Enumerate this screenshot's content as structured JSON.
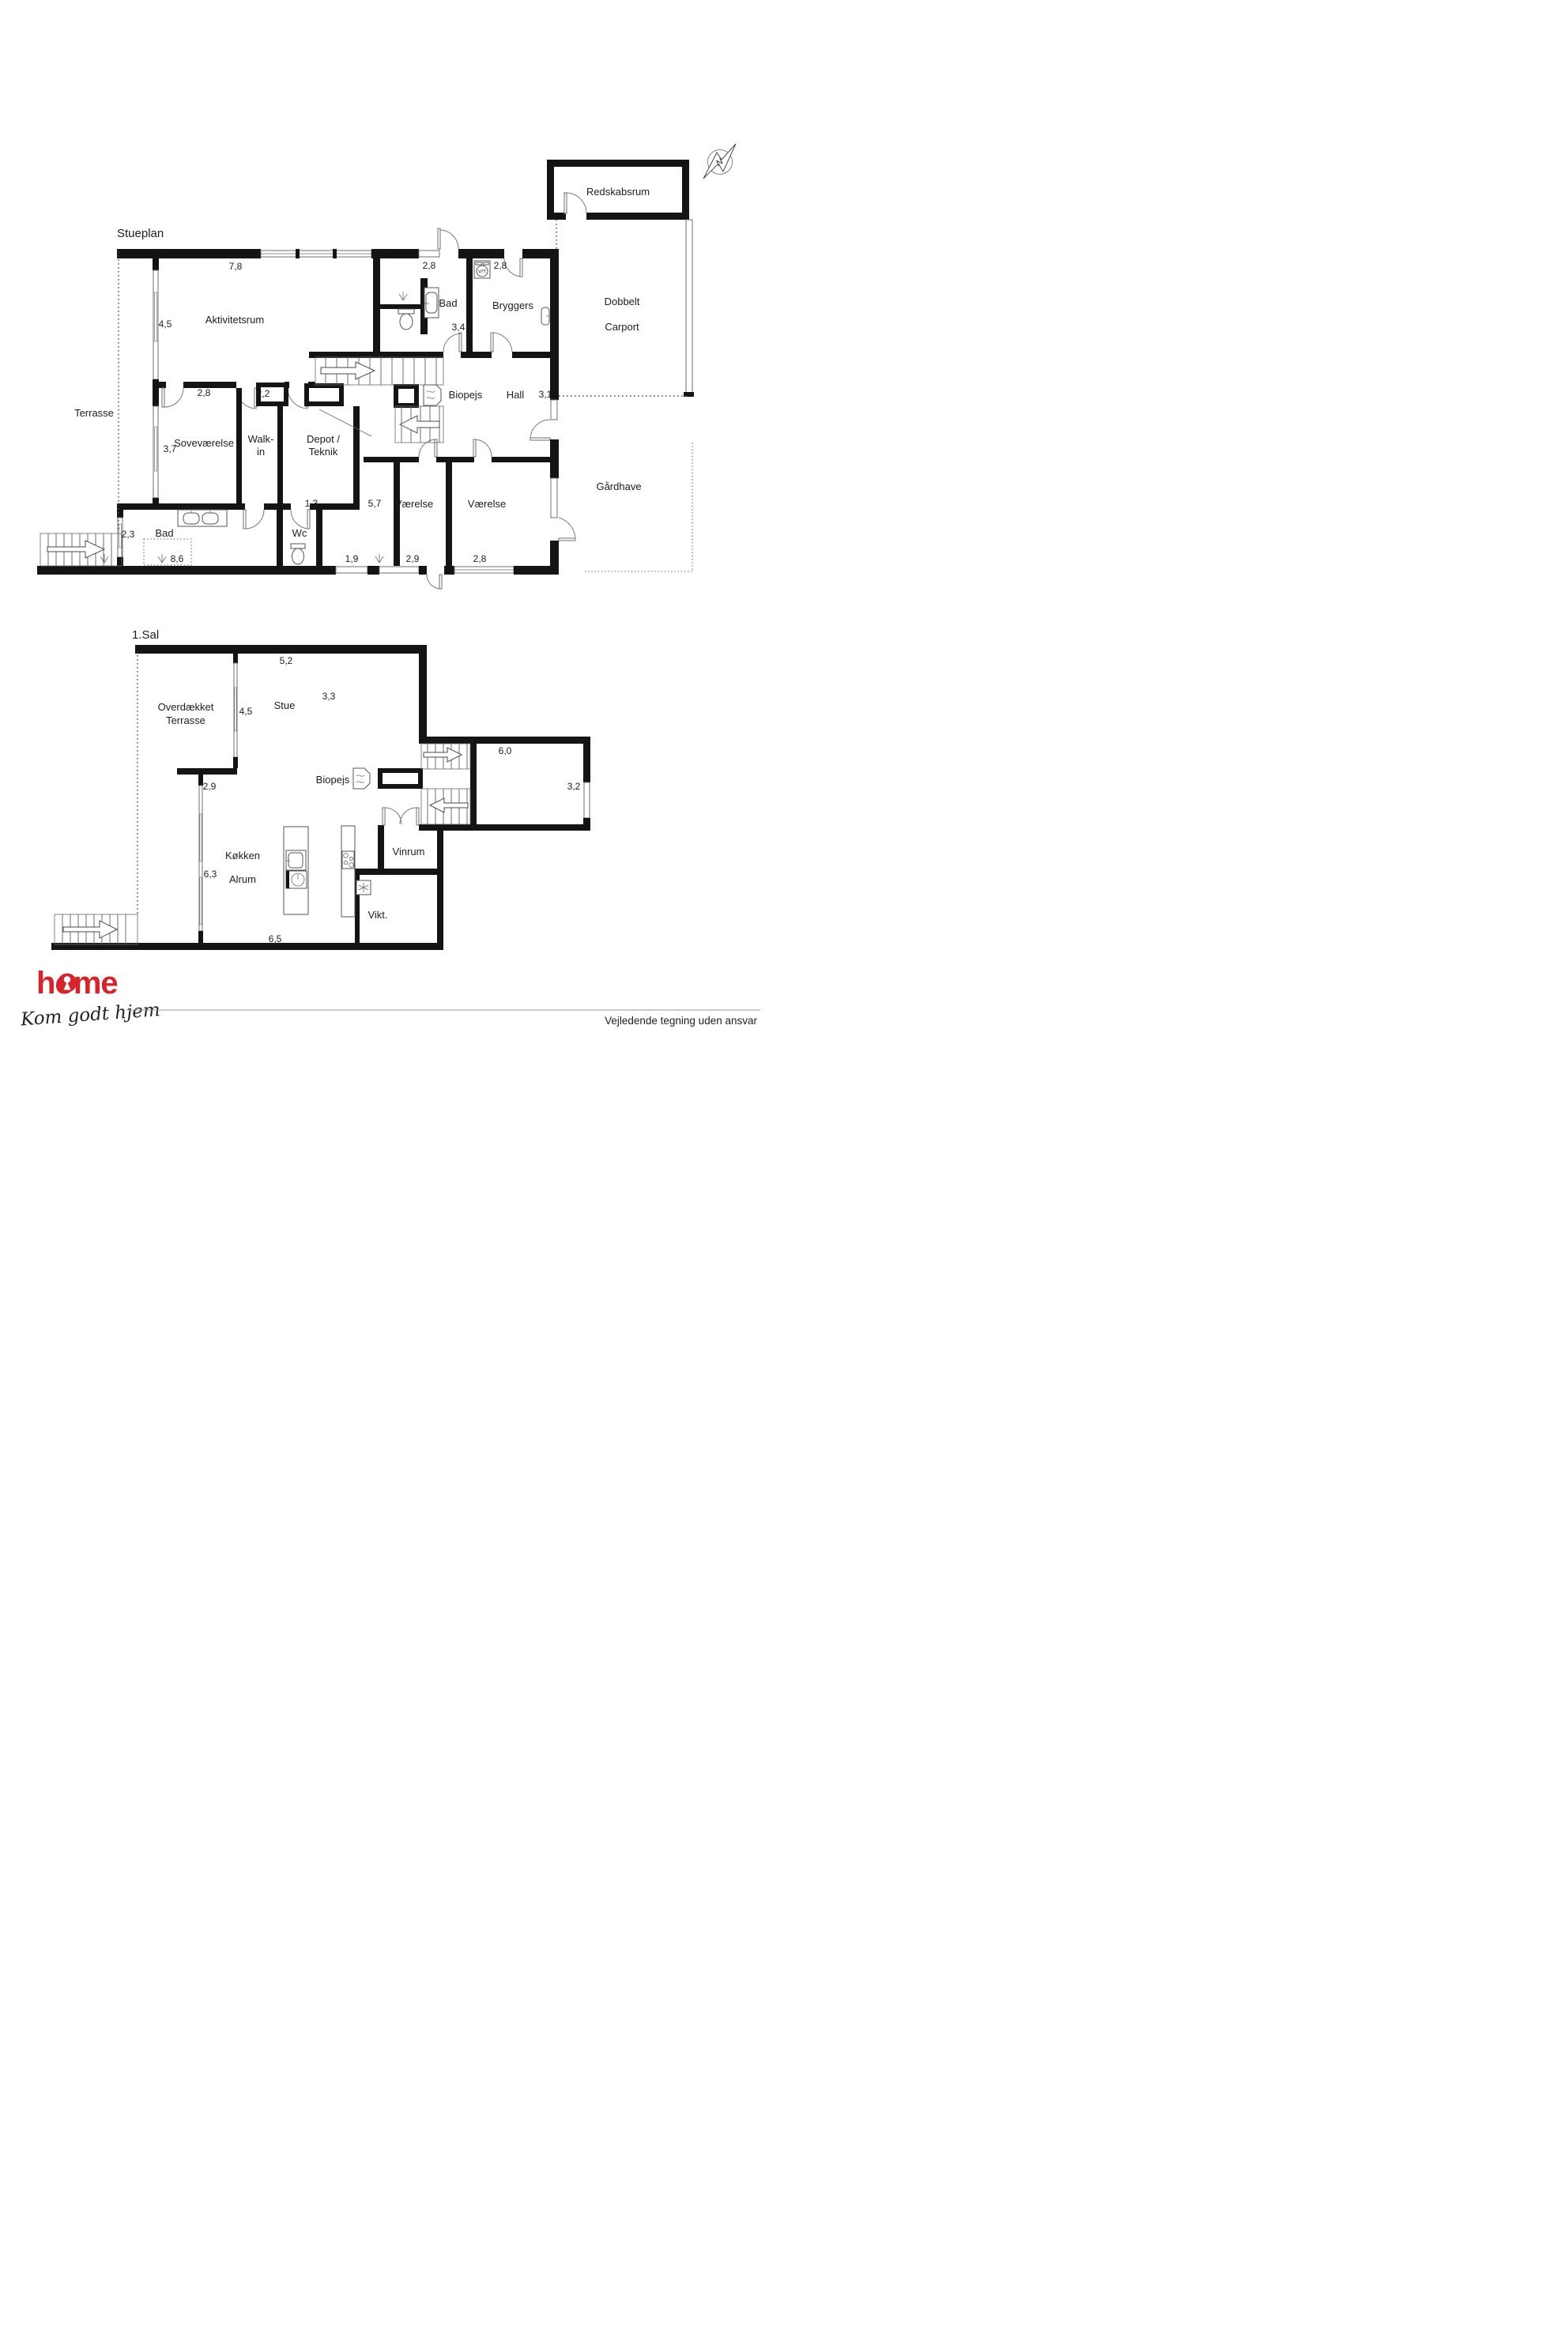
{
  "compass": {
    "label": "N"
  },
  "floors": {
    "stueplan": {
      "title": "Stueplan",
      "rooms": {
        "aktivitetsrum": "Aktivitetsrum",
        "bad_top": "Bad",
        "bryggers": "Bryggers",
        "redskabsrum": "Redskabsrum",
        "carport_line1": "Dobbelt",
        "carport_line2": "Carport",
        "terrasse": "Terrasse",
        "biopejs": "Biopejs",
        "hall": "Hall",
        "gaardhave": "Gårdhave",
        "sovevaerelse": "Soveværelse",
        "walkin_line1": "Walk-",
        "walkin_line2": "in",
        "depot_line1": "Depot /",
        "depot_line2": "Teknik",
        "vaerelse1": "Værelse",
        "vaerelse2": "Værelse",
        "bad_bottom": "Bad",
        "wc": "Wc"
      },
      "measurements": {
        "m78": "7,8",
        "m28_bad": "2,8",
        "m28_bryggers": "2,8",
        "m45": "4,5",
        "m34": "3,4",
        "m31": "3,1",
        "m28_sove": "2,8",
        "m22": "2,2",
        "m37": "3,7",
        "m13": "1,3",
        "m57": "5,7",
        "m23": "2,3",
        "m86": "8,6",
        "m19": "1,9",
        "m29": "2,9",
        "m28_vaerelse": "2,8"
      },
      "icons": {
        "washer": "V/T"
      }
    },
    "firstfloor": {
      "title": "1.Sal",
      "rooms": {
        "overdaekket_line1": "Overdækket",
        "overdaekket_line2": "Terrasse",
        "stue": "Stue",
        "biopejs": "Biopejs",
        "koekken": "Køkken",
        "alrum": "Alrum",
        "vinrum": "Vinrum",
        "vikt": "Vikt."
      },
      "measurements": {
        "m52": "5,2",
        "m33": "3,3",
        "m45": "4,5",
        "m60": "6,0",
        "m29": "2,9",
        "m32": "3,2",
        "m63": "6,3",
        "m65": "6,5"
      }
    }
  },
  "footer": {
    "logo": "home",
    "tagline": "Kom godt hjem",
    "disclaimer": "Vejledende tegning uden ansvar",
    "brand_red": "#d8232a"
  }
}
